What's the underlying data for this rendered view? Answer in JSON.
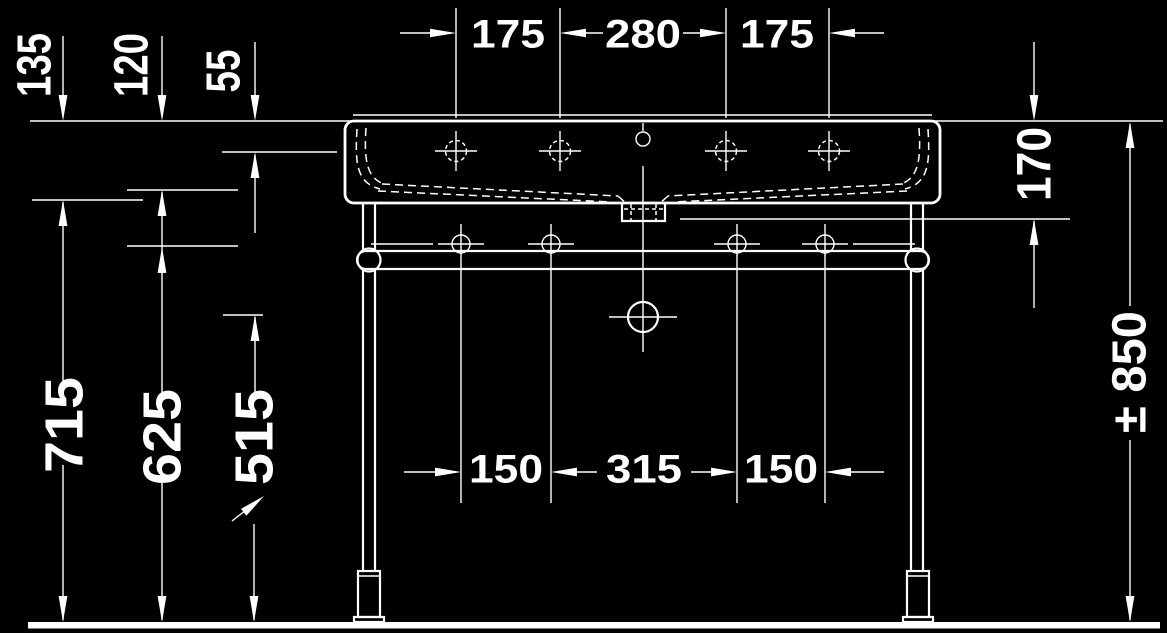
{
  "drawing": {
    "type": "technical-dimension-drawing",
    "subject": "washbasin with metal console stand, front view",
    "background_color": "#000000",
    "line_color": "#ffffff",
    "dims": {
      "top": [
        "175",
        "280",
        "175"
      ],
      "left_upper": [
        "135",
        "120",
        "55"
      ],
      "left_lower": [
        "715",
        "625",
        "515"
      ],
      "right": [
        "170",
        "± 850"
      ],
      "bottom": [
        "150",
        "315",
        "150"
      ]
    }
  }
}
